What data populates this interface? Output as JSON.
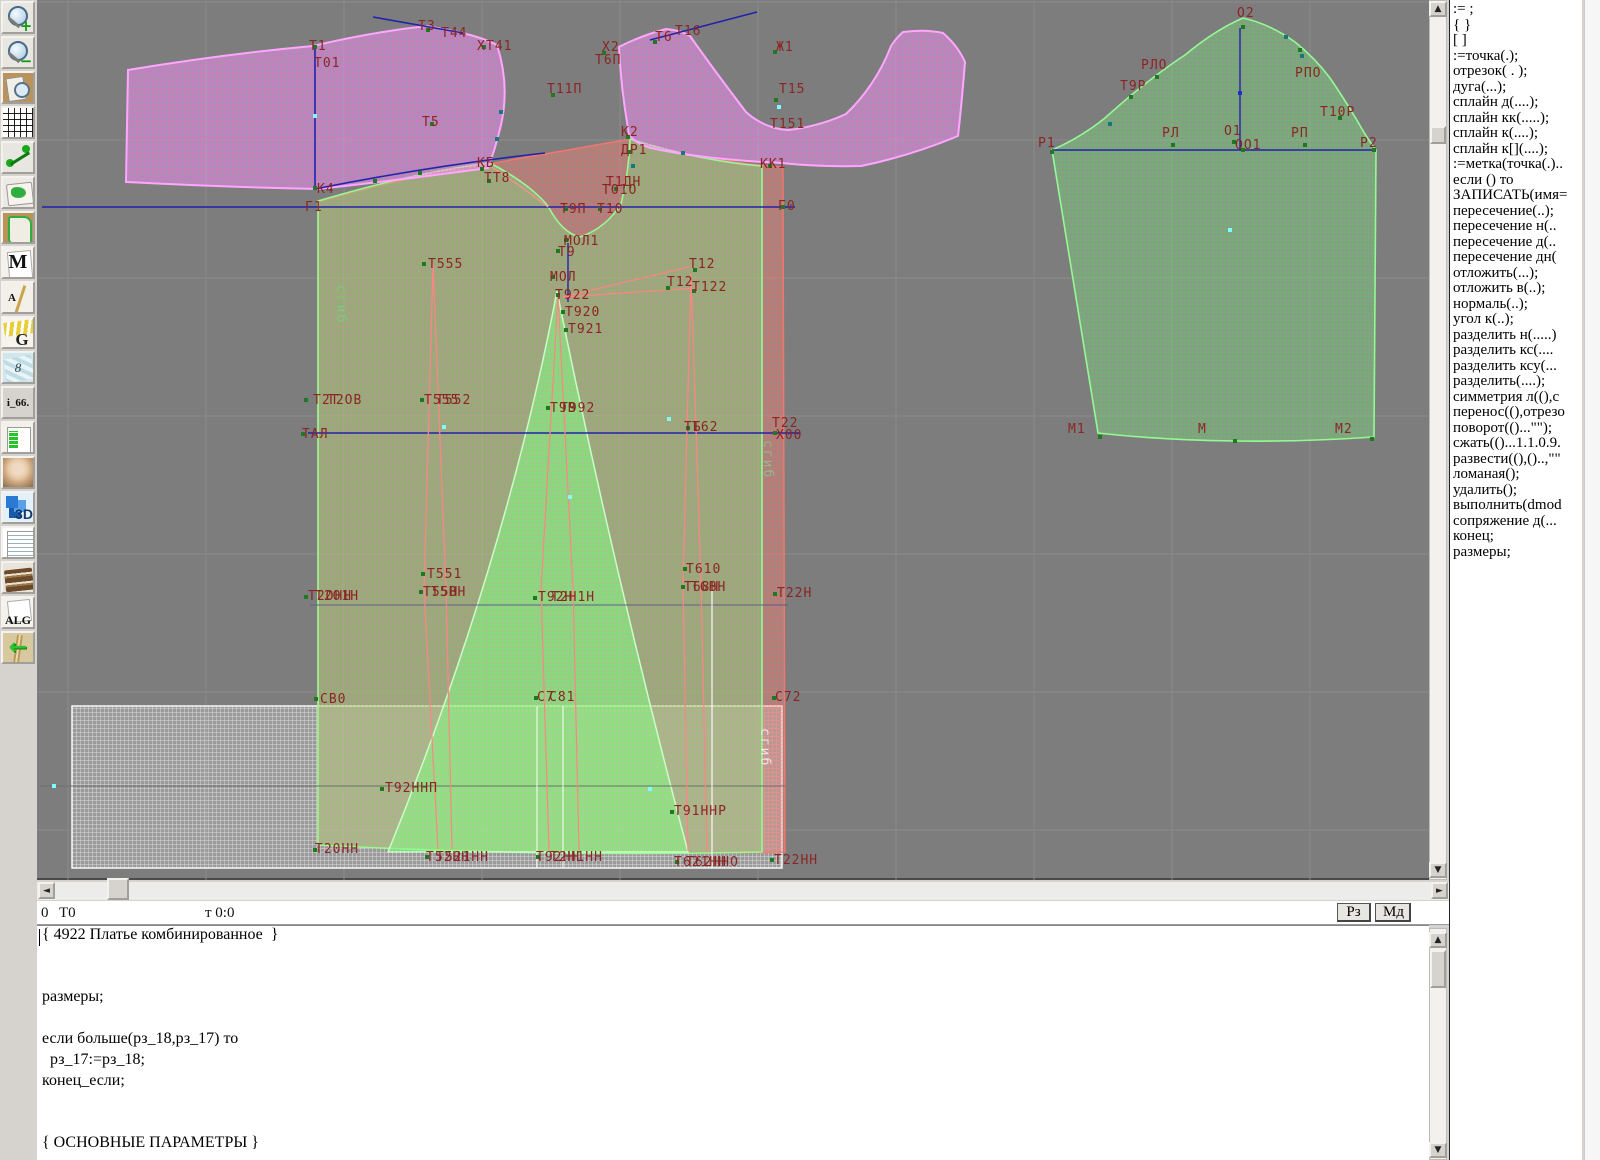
{
  "toolbar": {
    "items": [
      {
        "name": "zoom-in",
        "glyph": "+"
      },
      {
        "name": "zoom-out",
        "glyph": "−"
      },
      {
        "name": "sheet-preview",
        "glyph": ""
      },
      {
        "name": "grid",
        "glyph": ""
      },
      {
        "name": "measure",
        "glyph": ""
      },
      {
        "name": "map-sheet",
        "glyph": ""
      },
      {
        "name": "pattern-piece",
        "glyph": ""
      },
      {
        "name": "letter-m",
        "glyph": "M"
      },
      {
        "name": "drafting",
        "glyph": "A"
      },
      {
        "name": "g-curves",
        "glyph": "G"
      },
      {
        "name": "blueprint",
        "glyph": "8"
      },
      {
        "name": "i66",
        "glyph": "i_66."
      },
      {
        "name": "size-table",
        "glyph": ""
      },
      {
        "name": "model-photo",
        "glyph": ""
      },
      {
        "name": "three-d",
        "glyph": "3D"
      },
      {
        "name": "document",
        "glyph": ""
      },
      {
        "name": "books",
        "glyph": ""
      },
      {
        "name": "alg",
        "glyph": "ALG"
      },
      {
        "name": "import-arrow",
        "glyph": "←"
      }
    ]
  },
  "canvas": {
    "background": "#7d7d7d",
    "grid": {
      "step": 138,
      "x0": 68,
      "y0": 2,
      "color": "#8a8a8a"
    },
    "pieces": [
      {
        "name": "white-underlay",
        "cls": "p-white",
        "d": "M72,706 L782,706 L782,868 L72,868 Z"
      },
      {
        "name": "salmon-back-panel",
        "cls": "p-salmon",
        "d": "M318,202 Q430,171 490,164 Q520,158 545,154 L630,139 Q700,161 783,167 L785,852 Q550,857 318,845 Z"
      },
      {
        "name": "green-front-panel",
        "cls": "p-green",
        "d": "M318,201 Q420,171 490,163 Q530,184 548,206 Q562,233 580,237 Q606,228 621,204 Q629,172 630,139 Q700,161 762,166 L762,852 Q540,857 318,845 Z"
      },
      {
        "name": "green-gore-panel",
        "cls": "p-gore",
        "d": "M557,291 Q612,565 688,852 L388,852 Q505,565 557,291 Z"
      },
      {
        "name": "pink-bodice-left",
        "cls": "p-pink",
        "d": "M128,70 Q225,54 313,46 Q372,32 427,26 L448,30 Q480,36 497,45 Q510,85 501,125 Q495,150 488,168 Q400,180 318,189 Q220,187 126,182 Z"
      },
      {
        "name": "pink-yoke-right",
        "cls": "p-pink",
        "d": "M619,47 Q640,36 666,29 Q680,30 690,36 Q714,70 746,112 Q765,129 789,130 Q820,126 846,114 Q876,85 891,46 Q897,37 903,32 Q925,29 943,33 Q958,46 965,62 Q962,100 958,136 Q910,156 861,166 Q820,167 781,163 Q700,159 651,148 Q634,143 629,134 Q621,90 619,47 Z"
      },
      {
        "name": "sleeve",
        "cls": "p-green",
        "d": "M1052,150 Q1080,138 1105,118 Q1125,100 1140,88 Q1165,68 1185,55 Q1215,30 1243,18 Q1270,24 1295,42 Q1315,58 1330,78 Q1345,100 1358,122 Q1368,140 1376,150 L1374,437 Q1300,442 1235,441 Q1160,440 1098,433 Z"
      }
    ],
    "lines": [
      {
        "x1": 42,
        "y1": 207,
        "x2": 795,
        "y2": 207,
        "c": "#2222aa",
        "w": 1.4
      },
      {
        "x1": 308,
        "y1": 433,
        "x2": 800,
        "y2": 433,
        "c": "#2222aa",
        "w": 1.4
      },
      {
        "x1": 315,
        "y1": 47,
        "x2": 315,
        "y2": 188,
        "c": "#2222aa",
        "w": 1.6
      },
      {
        "x1": 373,
        "y1": 17,
        "x2": 463,
        "y2": 33,
        "c": "#2222aa",
        "w": 1.6
      },
      {
        "x1": 650,
        "y1": 40,
        "x2": 757,
        "y2": 12,
        "c": "#2222aa",
        "w": 1.6
      },
      {
        "x1": 1052,
        "y1": 150,
        "x2": 1376,
        "y2": 150,
        "c": "#2222aa",
        "w": 1.4
      },
      {
        "x1": 1240,
        "y1": 28,
        "x2": 1240,
        "y2": 150,
        "c": "#2222aa",
        "w": 1.4
      },
      {
        "x1": 40,
        "y1": 786,
        "x2": 785,
        "y2": 786,
        "c": "#6f6f6f",
        "w": 1
      },
      {
        "x1": 310,
        "y1": 605,
        "x2": 788,
        "y2": 605,
        "c": "#5f5f86",
        "w": 1
      },
      {
        "x1": 712,
        "y1": 585,
        "x2": 712,
        "y2": 868,
        "c": "rgba(255,255,255,0.85)",
        "w": 1.3
      },
      {
        "x1": 537,
        "y1": 706,
        "x2": 537,
        "y2": 868,
        "c": "rgba(255,255,255,0.8)",
        "w": 1.2
      },
      {
        "x1": 563,
        "y1": 706,
        "x2": 563,
        "y2": 868,
        "c": "rgba(255,255,255,0.8)",
        "w": 1.2
      }
    ],
    "strokes": [
      {
        "d": "M315,189 Q430,166 545,153",
        "c": "#2222aa",
        "w": 1.5
      },
      {
        "d": "M568,243 L568,302",
        "c": "#2222aa",
        "w": 1.4
      },
      {
        "d": "M433,264 L424,589",
        "c": "#ff8484",
        "w": 1.2
      },
      {
        "d": "M433,264 L446,589",
        "c": "#ff8484",
        "w": 1.2
      },
      {
        "d": "M424,589 L438,849",
        "c": "#ff8484",
        "w": 1.2
      },
      {
        "d": "M446,589 L452,849",
        "c": "#ff8484",
        "w": 1.2
      },
      {
        "d": "M558,296 L541,589",
        "c": "#ff8484",
        "w": 1.2
      },
      {
        "d": "M558,296 L573,589",
        "c": "#ff8484",
        "w": 1.2
      },
      {
        "d": "M541,589 L549,850",
        "c": "#ff8484",
        "w": 1.2
      },
      {
        "d": "M573,589 L579,850",
        "c": "#ff8484",
        "w": 1.2
      },
      {
        "d": "M691,273 L683,584",
        "c": "#ff8484",
        "w": 1.2
      },
      {
        "d": "M691,273 L701,584",
        "c": "#ff8484",
        "w": 1.2
      },
      {
        "d": "M683,584 L688,851",
        "c": "#ff8484",
        "w": 1.2
      },
      {
        "d": "M701,584 L707,852",
        "c": "#ff8484",
        "w": 1.2
      },
      {
        "d": "M563,297 L692,266",
        "c": "#ff8484",
        "w": 1.2
      },
      {
        "d": "M563,297 L698,288",
        "c": "#ff8484",
        "w": 1.2
      },
      {
        "d": "M490,166 Q520,185 548,207",
        "c": "#ff9090",
        "w": 1.2
      }
    ],
    "markers": {
      "green": [
        [
          315,
          47
        ],
        [
          428,
          30
        ],
        [
          484,
          47
        ],
        [
          432,
          124
        ],
        [
          315,
          188
        ],
        [
          482,
          169
        ],
        [
          489,
          181
        ],
        [
          553,
          95
        ],
        [
          566,
          209
        ],
        [
          600,
          209
        ],
        [
          604,
          53
        ],
        [
          655,
          42
        ],
        [
          775,
          52
        ],
        [
          776,
          100
        ],
        [
          628,
          137
        ],
        [
          629,
          152
        ],
        [
          616,
          189
        ],
        [
          770,
          166
        ],
        [
          783,
          207
        ],
        [
          566,
          240
        ],
        [
          558,
          251
        ],
        [
          553,
          277
        ],
        [
          558,
          295
        ],
        [
          563,
          312
        ],
        [
          566,
          330
        ],
        [
          424,
          264
        ],
        [
          695,
          270
        ],
        [
          694,
          291
        ],
        [
          668,
          288
        ],
        [
          306,
          400
        ],
        [
          422,
          400
        ],
        [
          548,
          408
        ],
        [
          303,
          434
        ],
        [
          688,
          428
        ],
        [
          775,
          433
        ],
        [
          423,
          574
        ],
        [
          421,
          592
        ],
        [
          306,
          597
        ],
        [
          535,
          598
        ],
        [
          685,
          569
        ],
        [
          683,
          587
        ],
        [
          775,
          594
        ],
        [
          316,
          699
        ],
        [
          536,
          698
        ],
        [
          774,
          698
        ],
        [
          382,
          789
        ],
        [
          672,
          812
        ],
        [
          315,
          850
        ],
        [
          427,
          857
        ],
        [
          538,
          857
        ],
        [
          677,
          862
        ],
        [
          772,
          860
        ],
        [
          375,
          181
        ],
        [
          420,
          173
        ],
        [
          1052,
          152
        ],
        [
          1131,
          97
        ],
        [
          1157,
          77
        ],
        [
          1243,
          27
        ],
        [
          1300,
          50
        ],
        [
          1340,
          118
        ],
        [
          1173,
          145
        ],
        [
          1234,
          142
        ],
        [
          1243,
          150
        ],
        [
          1305,
          145
        ],
        [
          1374,
          150
        ],
        [
          1100,
          437
        ],
        [
          1235,
          441
        ],
        [
          1372,
          439
        ]
      ],
      "cyan": [
        [
          315,
          116
        ],
        [
          779,
          107
        ],
        [
          444,
          427
        ],
        [
          669,
          419
        ],
        [
          1230,
          230
        ],
        [
          650,
          789
        ],
        [
          54,
          786
        ],
        [
          570,
          497
        ]
      ],
      "teal": [
        [
          501,
          112
        ],
        [
          497,
          139
        ],
        [
          633,
          166
        ],
        [
          1110,
          124
        ],
        [
          1286,
          37
        ],
        [
          1302,
          56
        ],
        [
          683,
          153
        ]
      ],
      "blue": [
        [
          1240,
          93
        ]
      ]
    },
    "labels": [
      {
        "t": "Т3",
        "x": 418,
        "y": 30
      },
      {
        "t": "Т44",
        "x": 441,
        "y": 37
      },
      {
        "t": "Т1",
        "x": 309,
        "y": 50
      },
      {
        "t": "Т01",
        "x": 314,
        "y": 67
      },
      {
        "t": "Х",
        "x": 477,
        "y": 50
      },
      {
        "t": "Т41",
        "x": 486,
        "y": 50
      },
      {
        "t": "Т5",
        "x": 422,
        "y": 126
      },
      {
        "t": "К4",
        "x": 317,
        "y": 193
      },
      {
        "t": "Г1",
        "x": 305,
        "y": 211
      },
      {
        "t": "КБ",
        "x": 477,
        "y": 167
      },
      {
        "t": "ТТ8",
        "x": 484,
        "y": 182
      },
      {
        "t": "Т11П",
        "x": 547,
        "y": 93
      },
      {
        "t": "Т9П",
        "x": 560,
        "y": 213
      },
      {
        "t": "Т10",
        "x": 597,
        "y": 213
      },
      {
        "t": "Х2",
        "x": 602,
        "y": 51
      },
      {
        "t": "Т6П",
        "x": 595,
        "y": 64
      },
      {
        "t": "Т6",
        "x": 655,
        "y": 41
      },
      {
        "t": "Т16",
        "x": 675,
        "y": 35
      },
      {
        "t": "Ж1",
        "x": 776,
        "y": 51
      },
      {
        "t": "Т15",
        "x": 779,
        "y": 93
      },
      {
        "t": "Т151",
        "x": 770,
        "y": 128
      },
      {
        "t": "К2",
        "x": 621,
        "y": 136
      },
      {
        "t": "ДР1",
        "x": 621,
        "y": 154
      },
      {
        "t": "Т1ДН",
        "x": 606,
        "y": 186
      },
      {
        "t": "ТО1О",
        "x": 602,
        "y": 194
      },
      {
        "t": "КК1",
        "x": 760,
        "y": 168
      },
      {
        "t": "Г0",
        "x": 778,
        "y": 210
      },
      {
        "t": "МОЛ1",
        "x": 564,
        "y": 245
      },
      {
        "t": "Т9",
        "x": 558,
        "y": 256
      },
      {
        "t": "МОЛ",
        "x": 550,
        "y": 281
      },
      {
        "t": "Т922",
        "x": 555,
        "y": 299
      },
      {
        "t": "Т920",
        "x": 565,
        "y": 316
      },
      {
        "t": "Т921",
        "x": 568,
        "y": 333
      },
      {
        "t": "Т555",
        "x": 428,
        "y": 268
      },
      {
        "t": "Т12",
        "x": 689,
        "y": 268
      },
      {
        "t": "Т12",
        "x": 667,
        "y": 286
      },
      {
        "t": "Т122",
        "x": 692,
        "y": 291
      },
      {
        "t": "Т2Т",
        "x": 313,
        "y": 404
      },
      {
        "t": "Т2ОВ",
        "x": 327,
        "y": 404
      },
      {
        "t": "Т555",
        "x": 424,
        "y": 404
      },
      {
        "t": "Т552",
        "x": 436,
        "y": 404
      },
      {
        "t": "Т9В",
        "x": 550,
        "y": 412
      },
      {
        "t": "Т992",
        "x": 560,
        "y": 412
      },
      {
        "t": "ТАЛ",
        "x": 302,
        "y": 438
      },
      {
        "t": "ТБ",
        "x": 684,
        "y": 431
      },
      {
        "t": "Т62",
        "x": 692,
        "y": 431
      },
      {
        "t": "Т22",
        "x": 772,
        "y": 427
      },
      {
        "t": "Х00",
        "x": 776,
        "y": 439
      },
      {
        "t": "Т551",
        "x": 427,
        "y": 578
      },
      {
        "t": "Т55Н",
        "x": 423,
        "y": 596
      },
      {
        "t": "Т5ВН",
        "x": 431,
        "y": 596
      },
      {
        "t": "Т2ОНН",
        "x": 308,
        "y": 600
      },
      {
        "t": "Т2О1Н",
        "x": 315,
        "y": 600
      },
      {
        "t": "Т92Н",
        "x": 538,
        "y": 601
      },
      {
        "t": "Т2Н1Н",
        "x": 551,
        "y": 601
      },
      {
        "t": "Т610",
        "x": 686,
        "y": 573
      },
      {
        "t": "Т68Н",
        "x": 684,
        "y": 591
      },
      {
        "t": "Т6ВН",
        "x": 691,
        "y": 591
      },
      {
        "t": "Т22Н",
        "x": 777,
        "y": 597
      },
      {
        "t": "СВ0",
        "x": 320,
        "y": 703
      },
      {
        "t": "С7",
        "x": 537,
        "y": 701
      },
      {
        "t": "С81",
        "x": 549,
        "y": 701
      },
      {
        "t": "С72",
        "x": 775,
        "y": 701
      },
      {
        "t": "Т92ННП",
        "x": 385,
        "y": 792
      },
      {
        "t": "Т91ННР",
        "x": 674,
        "y": 815
      },
      {
        "t": "Т20НН",
        "x": 315,
        "y": 853
      },
      {
        "t": "Т52НН",
        "x": 426,
        "y": 861
      },
      {
        "t": "Т521НН",
        "x": 436,
        "y": 861
      },
      {
        "t": "Т92НН",
        "x": 536,
        "y": 861
      },
      {
        "t": "Т2Н1НН",
        "x": 550,
        "y": 861
      },
      {
        "t": "Т621НН",
        "x": 674,
        "y": 866
      },
      {
        "t": "Т62ННО",
        "x": 686,
        "y": 866
      },
      {
        "t": "Т22НН",
        "x": 774,
        "y": 864
      },
      {
        "t": "О2",
        "x": 1237,
        "y": 17
      },
      {
        "t": "РЛО",
        "x": 1141,
        "y": 69
      },
      {
        "t": "Т9Р",
        "x": 1120,
        "y": 90
      },
      {
        "t": "РПО",
        "x": 1295,
        "y": 77
      },
      {
        "t": "Т10Р",
        "x": 1320,
        "y": 116
      },
      {
        "t": "Р1",
        "x": 1038,
        "y": 147
      },
      {
        "t": "РЛ",
        "x": 1162,
        "y": 137
      },
      {
        "t": "О1",
        "x": 1224,
        "y": 135
      },
      {
        "t": "ОО1",
        "x": 1235,
        "y": 149
      },
      {
        "t": "РП",
        "x": 1291,
        "y": 137
      },
      {
        "t": "Р2",
        "x": 1360,
        "y": 147
      },
      {
        "t": "М1",
        "x": 1068,
        "y": 433
      },
      {
        "t": "М",
        "x": 1198,
        "y": 433
      },
      {
        "t": "М2",
        "x": 1335,
        "y": 433
      }
    ],
    "vlabels": [
      {
        "t": "сгиб",
        "x": 337,
        "y": 285,
        "c": "#7ec87e"
      },
      {
        "t": "сгиб",
        "x": 764,
        "y": 440,
        "c": "#8fbc8f"
      },
      {
        "t": "сгиб",
        "x": 761,
        "y": 728,
        "c": "#e8e8e8"
      }
    ]
  },
  "command_panel": {
    "items": [
      ":= ;",
      "{  }",
      "[  ]",
      ":=точка(.);",
      "отрезок( . );",
      "дуга(...);",
      "сплайн  д(....);",
      "сплайн  кк(.....);",
      "сплайн  к(....);",
      "сплайн  к[](....);",
      ":=метка(точка(.)..",
      "если () то",
      "ЗАПИСАТЬ(имя=",
      "пересечение(..);",
      "пересечение  н(..",
      "пересечение  д(..",
      "пересечение  дн(",
      "отложить(...);",
      "отложить  в(..);",
      "нормаль(..);",
      "угол  к(..);",
      "разделить  н(.....)",
      "разделить  кс(....",
      "разделить  ксу(...",
      "разделить(....);",
      "симметрия  л((),с",
      "перенос((),отрезо",
      "поворот(()...\"\");",
      "сжать(()...1.1.0.9.",
      "развести((),()..,\"\"",
      "ломаная();",
      "удалить();",
      "выполнить(dmod",
      "сопряжение  д(...",
      "конец;",
      "размеры;"
    ]
  },
  "statusbar": {
    "left_num": "0",
    "point_name": "Т0",
    "coords": "т 0:0",
    "btn_rz": "Рз",
    "btn_md": "Мд"
  },
  "editor": {
    "lines": [
      "{ 4922 Платье комбинированное  }",
      "",
      "",
      "размеры;",
      "",
      "если больше(рз_18,рз_17) то",
      "  рз_17:=рз_18;",
      "конец_если;",
      "",
      "",
      "{ ОСНОВНЫЕ ПАРАМЕТРЫ }"
    ]
  }
}
